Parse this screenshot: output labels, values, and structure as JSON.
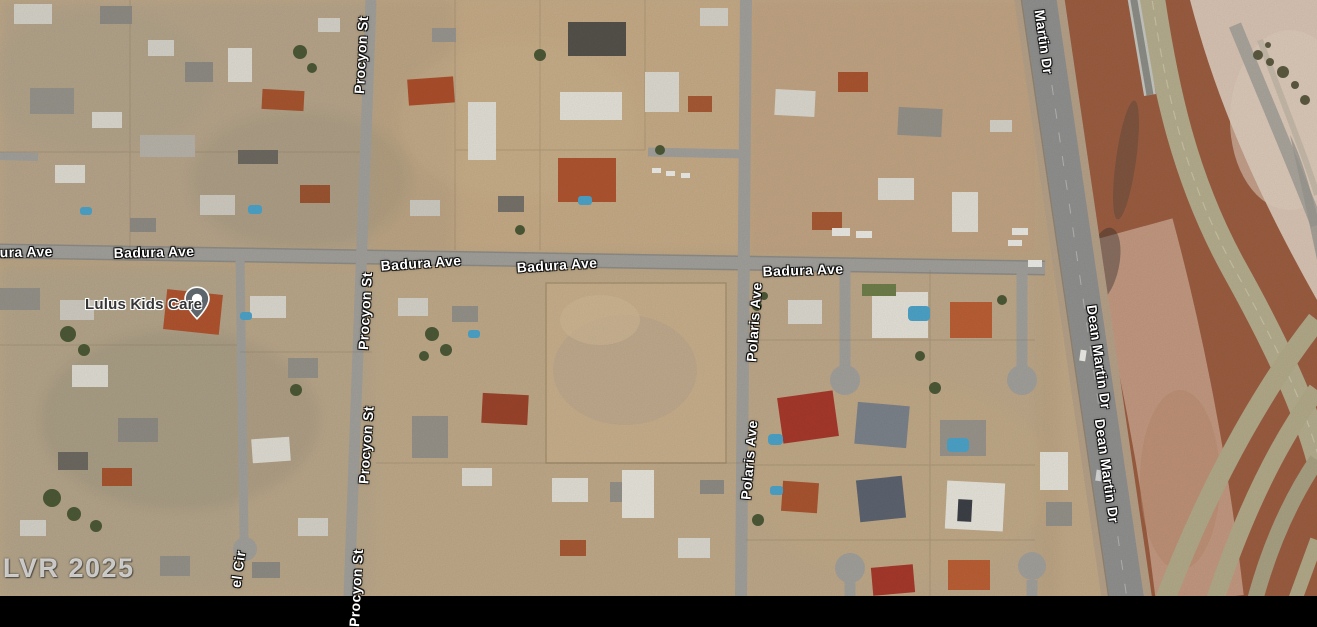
{
  "map": {
    "view_type": "satellite",
    "watermark": "LVR 2025",
    "place_label": {
      "name": "Lulus Kids Care",
      "marker": "place-pin"
    },
    "road_labels": [
      {
        "name": "badura-ave-1",
        "text": "Badura Ave"
      },
      {
        "name": "badura-ave-2",
        "text": "Badura Ave"
      },
      {
        "name": "badura-ave-3",
        "text": "Badura Ave"
      },
      {
        "name": "badura-ave-4",
        "text": "Badura Ave"
      },
      {
        "name": "badura-ave-5",
        "text": "Badura Ave"
      },
      {
        "name": "procyon-st-1",
        "text": "Procyon St"
      },
      {
        "name": "procyon-st-2",
        "text": "Procyon St"
      },
      {
        "name": "procyon-st-3",
        "text": "Procyon St"
      },
      {
        "name": "procyon-st-4",
        "text": "Procyon St"
      },
      {
        "name": "polaris-ave-1",
        "text": "Polaris Ave"
      },
      {
        "name": "polaris-ave-2",
        "text": "Polaris Ave"
      },
      {
        "name": "martin-dr",
        "text": "Martin Dr"
      },
      {
        "name": "dean-martin-dr-1",
        "text": "Dean Martin Dr"
      },
      {
        "name": "dean-martin-dr-2",
        "text": "Dean Martin Dr"
      },
      {
        "name": "el-cir",
        "text": "el Cir"
      }
    ],
    "colors": {
      "desert": "#c3ab89",
      "road": "#a3a19c",
      "highway": "#919190",
      "freeway_dirt": "#9c5e41",
      "ramp": "#b6ae8e",
      "pink_desert": "#d9c5b4",
      "pool": "#4da4c9",
      "roof_terracotta": "#b1542f"
    }
  }
}
